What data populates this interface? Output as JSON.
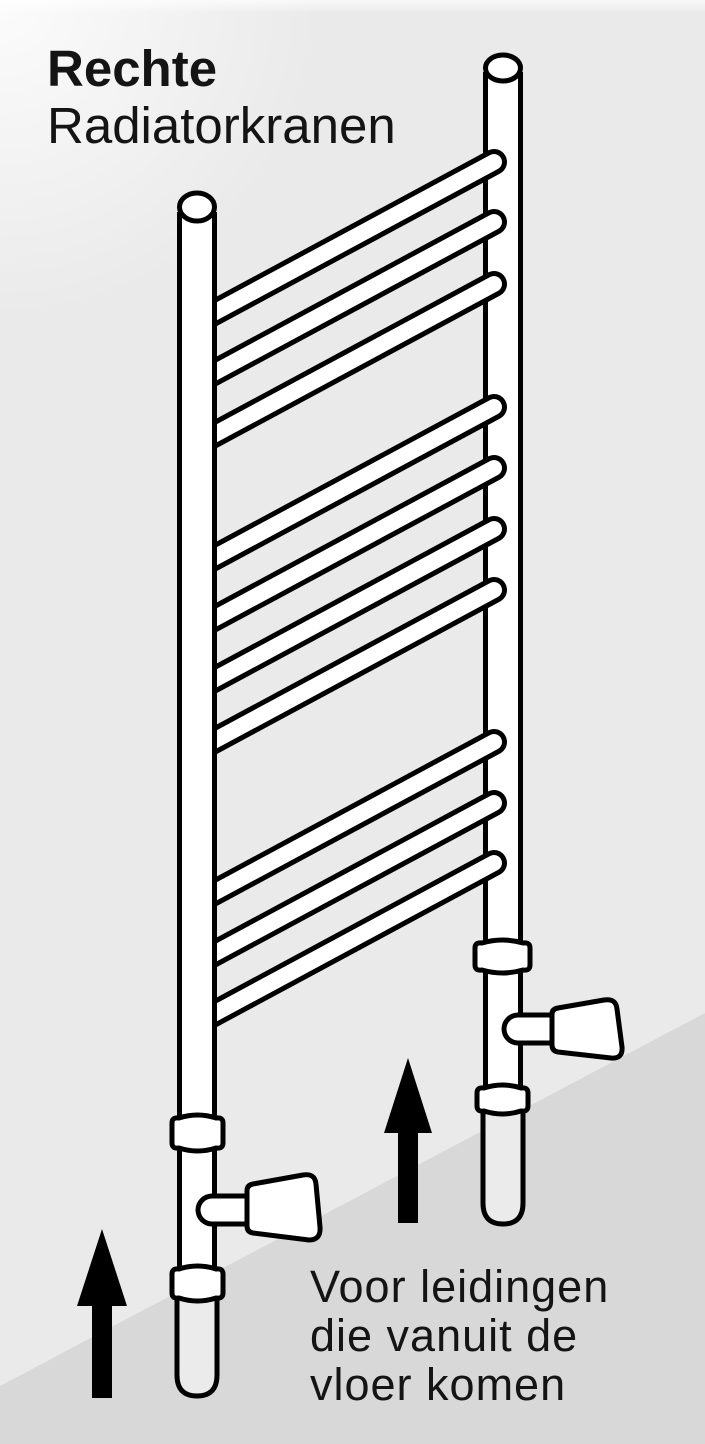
{
  "meta": {
    "type": "instructional-diagram",
    "language": "nl",
    "subject": "towel-radiator-with-straight-valves"
  },
  "title": {
    "line1": "Rechte",
    "line2": "Radiatorkranen"
  },
  "caption": {
    "line1": "Voor leidingen",
    "line2": "die vanuit de",
    "line3": "vloer komen"
  },
  "illustration": {
    "description": "Ladder-style towel radiator with two vertical pipes, 10 rungs in groups of 3-4-3, a straight valve with conical knob on each pipe, and two black arrows pointing up from the floor",
    "rung_count": 10,
    "rung_groups": [
      3,
      4,
      3
    ],
    "valve_count": 2,
    "icons": [
      "up-arrow-icon",
      "up-arrow-icon"
    ]
  },
  "colors": {
    "bg_top": "#eaeaea",
    "bg_bottom": "#d8d8d8",
    "ink": "#000000",
    "paper": "#ffffff",
    "pipe_gray": "#ebebeb",
    "text": "#141414"
  }
}
